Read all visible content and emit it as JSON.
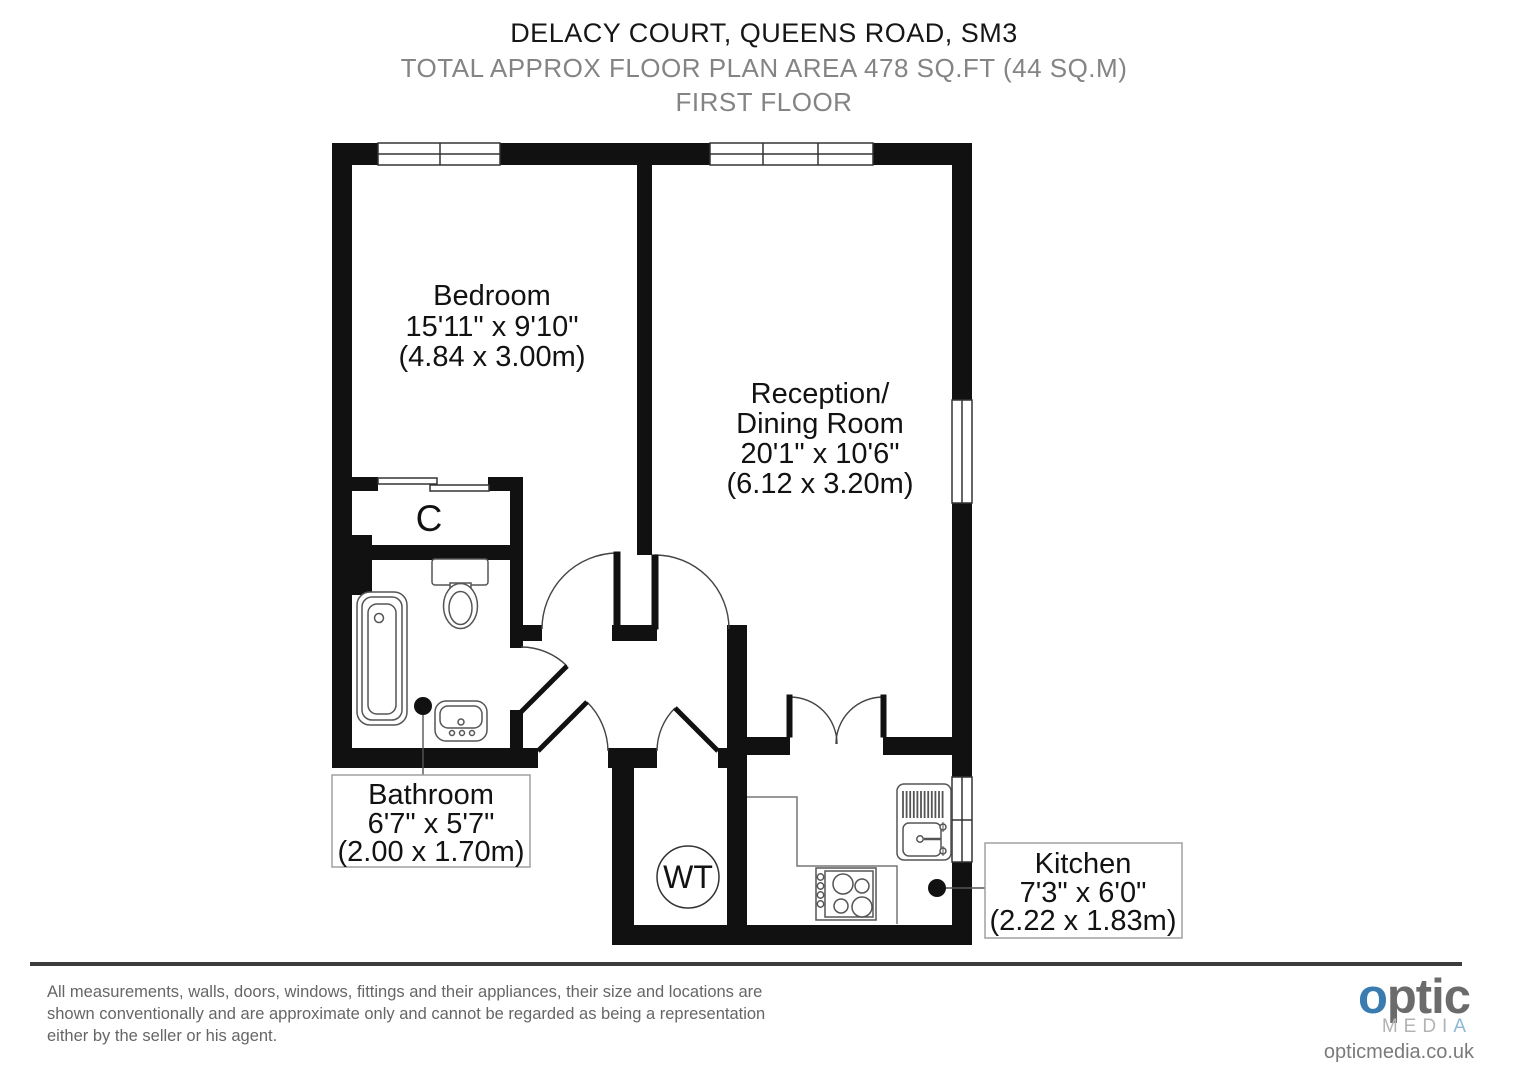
{
  "header": {
    "title": "DELACY COURT, QUEENS ROAD, SM3",
    "subtitle": "TOTAL APPROX FLOOR PLAN AREA 478 SQ.FT (44 SQ.M)",
    "floor": "FIRST FLOOR"
  },
  "rooms": {
    "bedroom": {
      "name": "Bedroom",
      "dims_ft": "15'11\" x 9'10\"",
      "dims_m": "(4.84 x 3.00m)"
    },
    "reception": {
      "name1": "Reception/",
      "name2": "Dining Room",
      "dims_ft": "20'1\" x 10'6\"",
      "dims_m": "(6.12 x 3.20m)"
    },
    "bathroom": {
      "name": "Bathroom",
      "dims_ft": "6'7\" x 5'7\"",
      "dims_m": "(2.00 x 1.70m)"
    },
    "kitchen": {
      "name": "Kitchen",
      "dims_ft": "7'3\" x 6'0\"",
      "dims_m": "(2.22 x 1.83m)"
    },
    "cupboard": {
      "label": "C"
    },
    "water_tank": {
      "label": "WT"
    }
  },
  "footer": {
    "disclaimer_line1": "All measurements, walls, doors, windows, fittings and their appliances, their size and locations are",
    "disclaimer_line2": "shown conventionally and are approximate only and cannot be regarded as being a representation",
    "disclaimer_line3": "either by the seller or his agent."
  },
  "logo": {
    "part1": "o",
    "part2": "ptic",
    "media": "MEDI",
    "media_a": "A",
    "url": "opticmedia.co.uk"
  },
  "colors": {
    "wall": "#111111",
    "fixture_stroke": "#555555",
    "label_box_border": "#a0a0a0",
    "muted_text": "#848484",
    "logo_blue": "#3a7cb0",
    "logo_gray": "#6b6b6b"
  }
}
